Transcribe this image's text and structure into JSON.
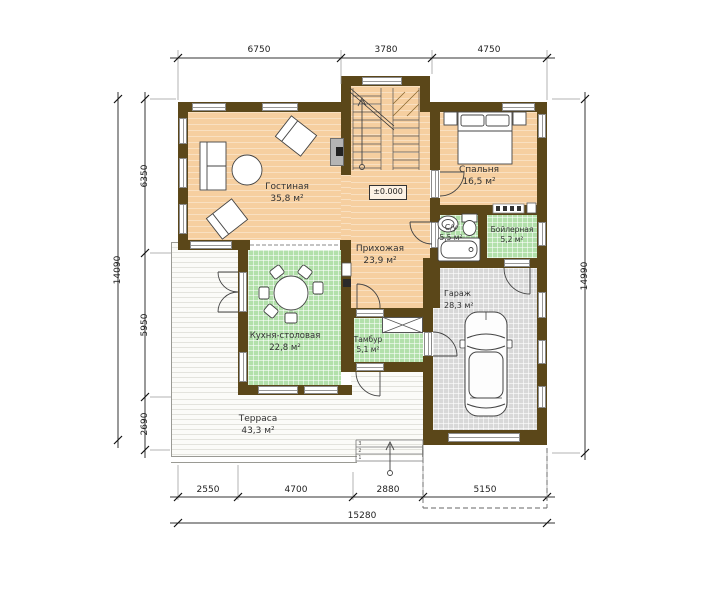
{
  "rooms": {
    "living": {
      "name": "Гостиная",
      "area": "35,8 м²"
    },
    "bedroom": {
      "name": "Спальня",
      "area": "16,5 м²"
    },
    "hallway": {
      "name": "Прихожая",
      "area": "23,9 м²"
    },
    "bathroom": {
      "name": "С/у",
      "area": "5,5 м²"
    },
    "boiler": {
      "name": "Бойлерная",
      "area": "5,2 м²"
    },
    "kitchen": {
      "name": "Кухня-столовая",
      "area": "22,8 м²"
    },
    "vestibule": {
      "name": "Тамбур",
      "area": "5,1 м²"
    },
    "garage": {
      "name": "Гараж",
      "area": "28,3 м²"
    },
    "terrace": {
      "name": "Терраса",
      "area": "43,3 м²"
    }
  },
  "level_mark": "±0.000",
  "dimensions": {
    "top": [
      "6750",
      "3780",
      "4750"
    ],
    "bottom": [
      "2550",
      "4700",
      "2880",
      "5150"
    ],
    "bottom_total": "15280",
    "left": [
      "6350",
      "5950",
      "2690"
    ],
    "left_total": "14090",
    "right_total": "14990"
  },
  "steps": [
    "1",
    "2",
    "3"
  ],
  "colors": {
    "wall": "#5b4719",
    "floor_main": "#f6cfa0",
    "floor_tile": "#b2e0aa",
    "floor_garage": "#d8d8d8",
    "terrace": "#fbfbf8"
  }
}
